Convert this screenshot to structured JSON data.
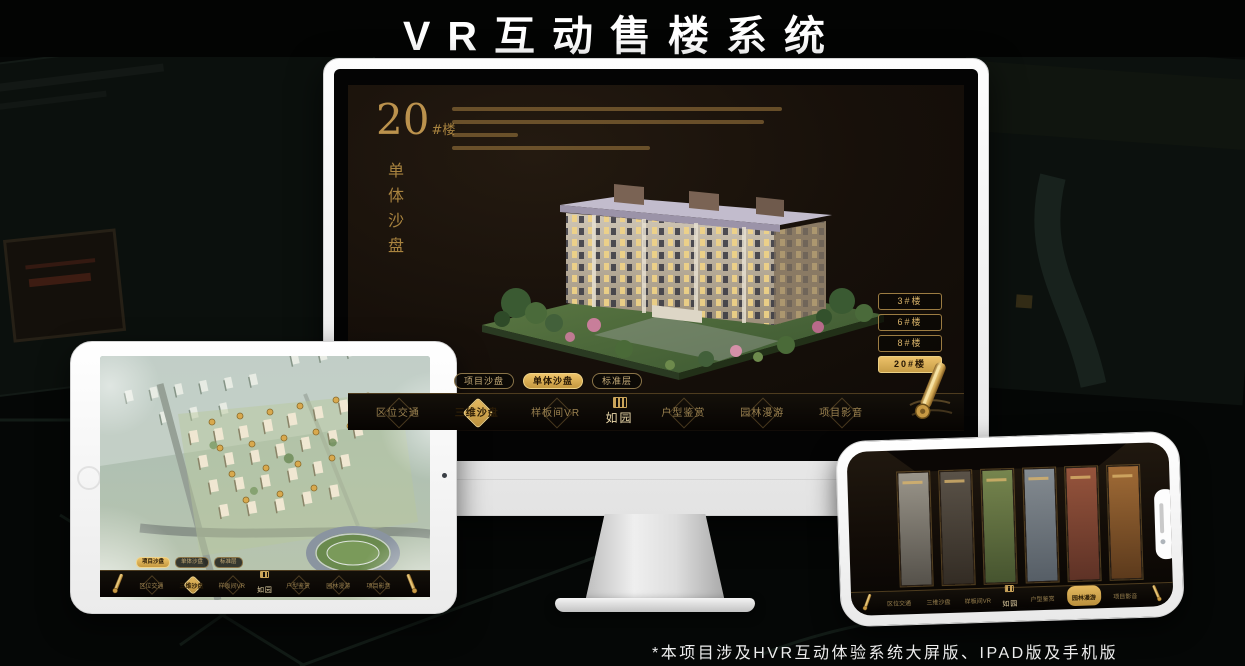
{
  "title": "VR互动售楼系统",
  "footnote": "*本项目涉及HVR互动体验系统大屏版、IPAD版及手机版",
  "colors": {
    "gold": "#cda353",
    "gold_bright": "#ecc169",
    "screen_bg": "#17100a",
    "nav_bg": "#0a0703",
    "device_white": "#fdfdfd"
  },
  "logo": {
    "name": "如园"
  },
  "monitor_ui": {
    "headline": {
      "number": "20",
      "suffix": "#楼",
      "vertical": "单体沙盘"
    },
    "floor_buttons": [
      {
        "label": "3#楼",
        "active": false
      },
      {
        "label": "6#楼",
        "active": false
      },
      {
        "label": "8#楼",
        "active": false
      },
      {
        "label": "20#楼",
        "active": true
      }
    ],
    "sub_tabs": [
      {
        "label": "项目沙盘",
        "active": false
      },
      {
        "label": "单体沙盘",
        "active": true
      },
      {
        "label": "标准层",
        "active": false
      }
    ],
    "nav_items": [
      {
        "label": "区位交通",
        "active": false
      },
      {
        "label": "三维沙盘",
        "active": true
      },
      {
        "label": "样板间VR",
        "active": false
      },
      {
        "label": "户型鉴赏",
        "active": false
      },
      {
        "label": "园林漫游",
        "active": false
      },
      {
        "label": "项目影音",
        "active": false
      }
    ]
  },
  "tablet_ui": {
    "sub_tabs": [
      {
        "label": "项目沙盘",
        "active": true
      },
      {
        "label": "单体沙盘",
        "active": false
      },
      {
        "label": "标准层",
        "active": false
      }
    ],
    "nav_items": [
      {
        "label": "区位交通",
        "active": false
      },
      {
        "label": "三维沙盘",
        "active": true
      },
      {
        "label": "样板间VR",
        "active": false
      },
      {
        "label": "户型鉴赏",
        "active": false
      },
      {
        "label": "园林漫游",
        "active": false
      },
      {
        "label": "项目影音",
        "active": false
      }
    ]
  },
  "phone_ui": {
    "nav_items": [
      {
        "label": "区位交通",
        "active": false
      },
      {
        "label": "三维沙盘",
        "active": false
      },
      {
        "label": "样板间VR",
        "active": false
      },
      {
        "label": "户型鉴赏",
        "active": false
      },
      {
        "label": "园林漫游",
        "active": true
      },
      {
        "label": "项目影音",
        "active": false
      }
    ]
  }
}
